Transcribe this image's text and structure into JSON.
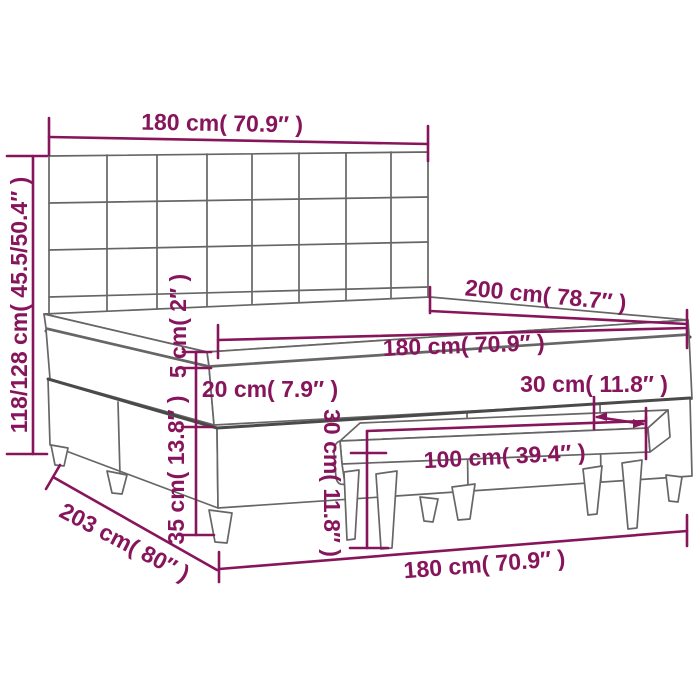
{
  "diagram": {
    "type": "furniture-dimension-diagram",
    "subject": "box-spring-bed-with-mattress-topper-and-bench",
    "labels": {
      "top_width": "180 cm( 70.9″ )",
      "total_height": "118/128 cm( 45.5/50.4″ )",
      "topper_thickness": "5 cm( 2″ )",
      "mattress_thickness": "20 cm( 7.9″ )",
      "base_height": "35 cm( 13.8″ )",
      "bed_length": "200 cm( 78.7″ )",
      "mattress_width": "180 cm( 70.9″ )",
      "bench_depth": "30 cm( 11.8″ )",
      "bench_height": "30 cm( 11.8″ )",
      "bench_width": "100 cm( 39.4″ )",
      "front_width": "180 cm( 70.9″ )",
      "total_length": "203 cm( 80″ )"
    },
    "colors": {
      "accent": "#87155B",
      "line_art": "#666666",
      "line_art_dark": "#4a4a4a",
      "background": "#ffffff"
    }
  }
}
